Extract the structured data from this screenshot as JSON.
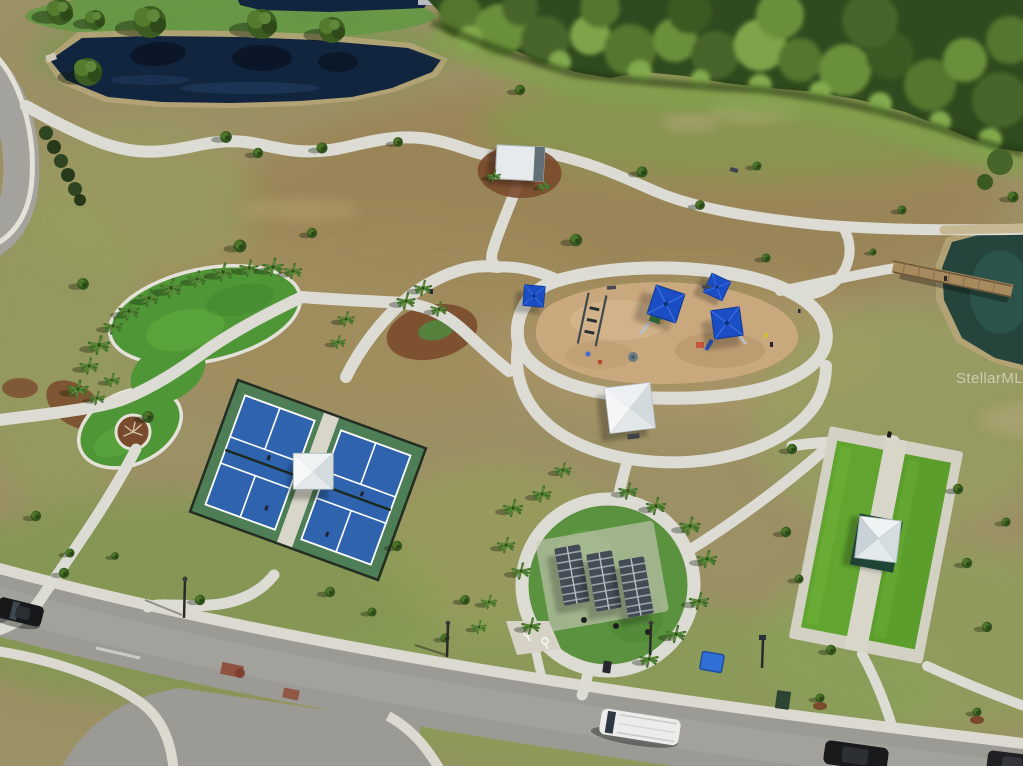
{
  "watermark": {
    "text": "StellarMLS"
  },
  "scene": {
    "description": "Aerial drone photograph of a community park amenity campus",
    "features": [
      {
        "name": "pond-top-left",
        "label": "retention pond"
      },
      {
        "name": "forest-top-right",
        "label": "dense tree line"
      },
      {
        "name": "event-lawn",
        "label": "kidney-shaped event lawn lined with palms"
      },
      {
        "name": "pickleball-courts",
        "label": "two fenced blue pickleball courts with shade structure"
      },
      {
        "name": "playground",
        "label": "sand playground with blue shade canopies"
      },
      {
        "name": "picnic-circle",
        "label": "circular picnic plaza with three metal-roof shelters"
      },
      {
        "name": "bocce-courts",
        "label": "two artificial-turf bocce courts with pavilion"
      },
      {
        "name": "boardwalk",
        "label": "wood boardwalk over pond"
      },
      {
        "name": "street",
        "label": "residential street with parked vehicles"
      },
      {
        "name": "paths",
        "label": "winding concrete walking paths"
      }
    ]
  },
  "palette": {
    "ground": "#9c9065",
    "grass_green": "#7e9850",
    "pond": "#12253f",
    "pond_right": "#24443c",
    "forest": "#2f4a1e",
    "path": "#dcdcd4",
    "road": "#9b9a95",
    "court_blue": "#2f63ae",
    "court_green": "#4e7e55",
    "lawn_green": "#4f9636",
    "turf_green": "#5ea32e",
    "sand": "#c9a87e",
    "canopy_blue": "#1b4ec4",
    "mulch": "#7a4a2c",
    "roof_white": "#e9edef"
  }
}
